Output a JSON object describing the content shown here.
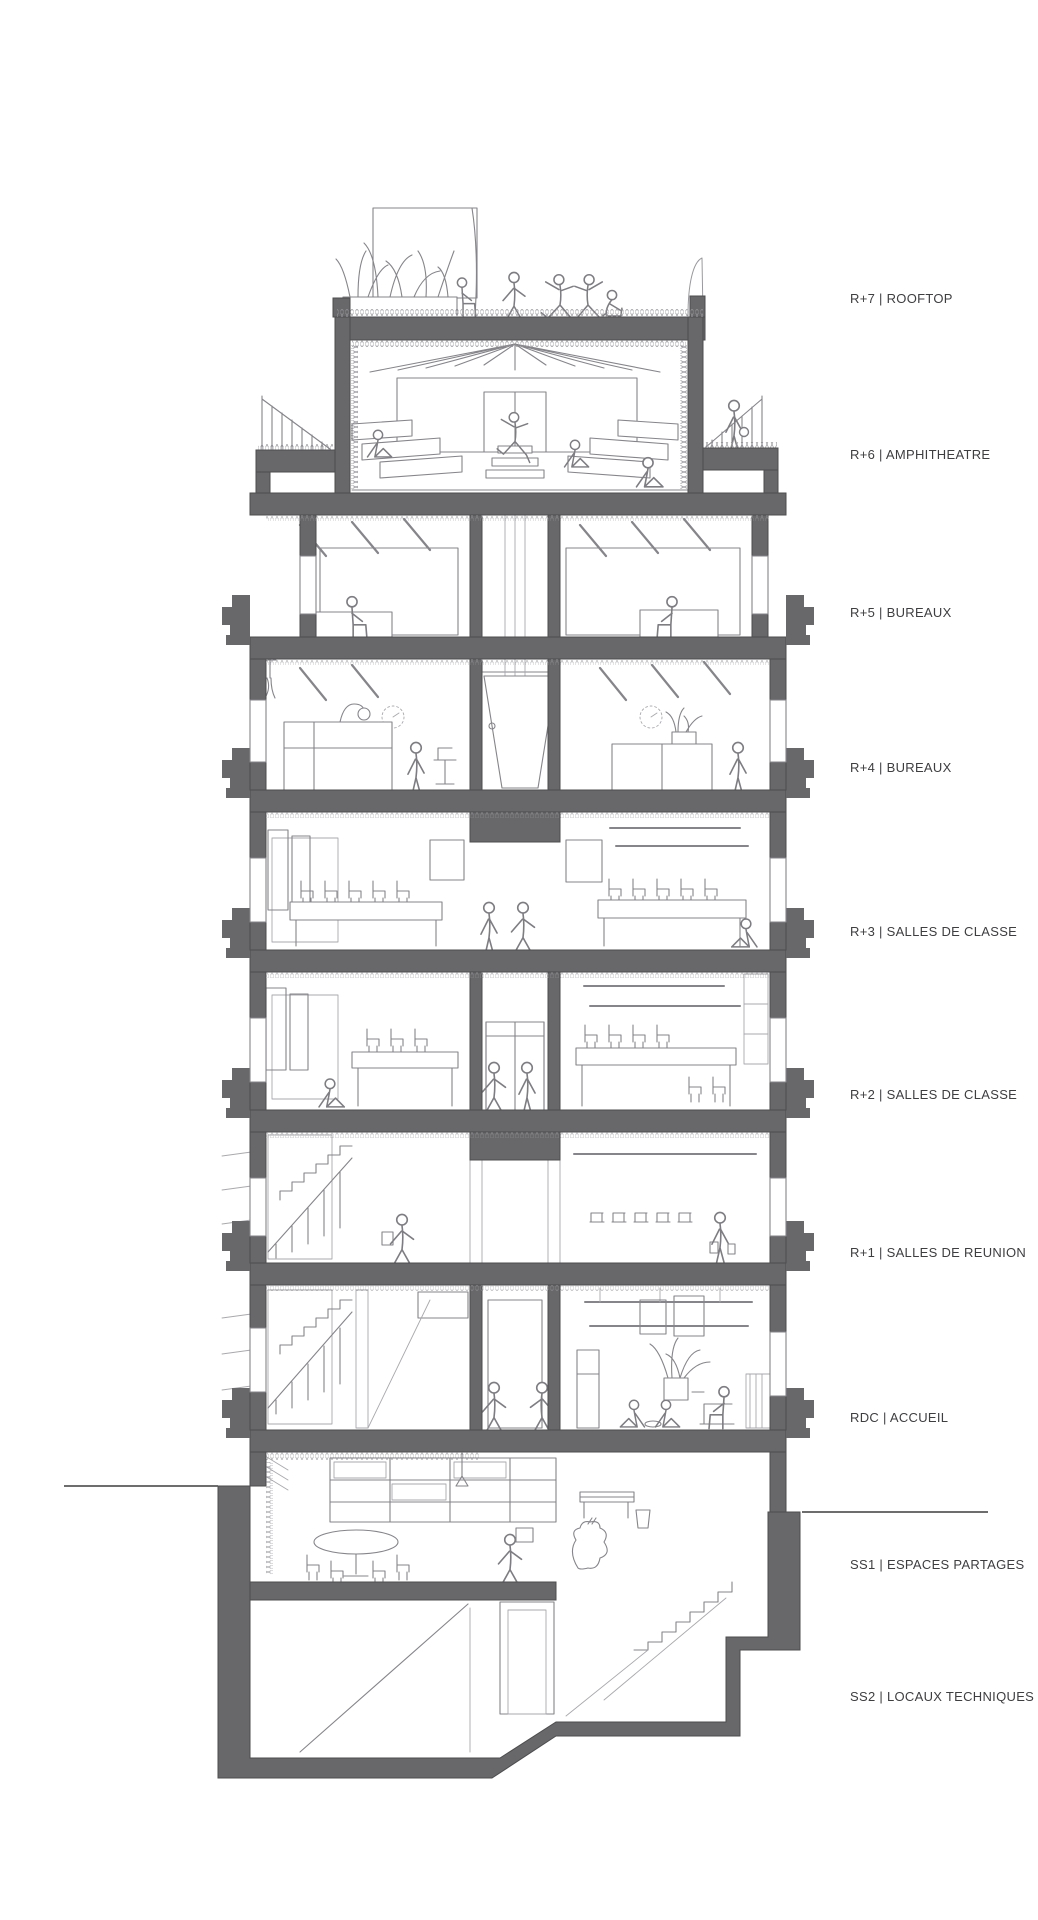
{
  "page": {
    "background": "#ffffff"
  },
  "drawing": {
    "type": "architectural-section",
    "poche_color": "#68686a",
    "ink_color": "#85858a",
    "figure_color": "#7d7d82",
    "hatch_color": "#9a9a9e",
    "label_color": "#3e3e41"
  },
  "floor_labels": [
    {
      "id": "r7",
      "label": "R+7 | ROOFTOP",
      "y": 299
    },
    {
      "id": "r6",
      "label": "R+6 | AMPHITHEATRE",
      "y": 455
    },
    {
      "id": "r5",
      "label": "R+5 | BUREAUX",
      "y": 613
    },
    {
      "id": "r4",
      "label": "R+4 | BUREAUX",
      "y": 768
    },
    {
      "id": "r3",
      "label": "R+3 | SALLES DE CLASSE",
      "y": 932
    },
    {
      "id": "r2",
      "label": "R+2 | SALLES DE CLASSE",
      "y": 1095
    },
    {
      "id": "r1",
      "label": "R+1 | SALLES DE REUNION",
      "y": 1253
    },
    {
      "id": "rdc",
      "label": "RDC | ACCUEIL",
      "y": 1418
    },
    {
      "id": "ss1",
      "label": "SS1 | ESPACES PARTAGES",
      "y": 1565
    },
    {
      "id": "ss2",
      "label": "SS2 | LOCAUX TECHNIQUES",
      "y": 1697
    }
  ]
}
